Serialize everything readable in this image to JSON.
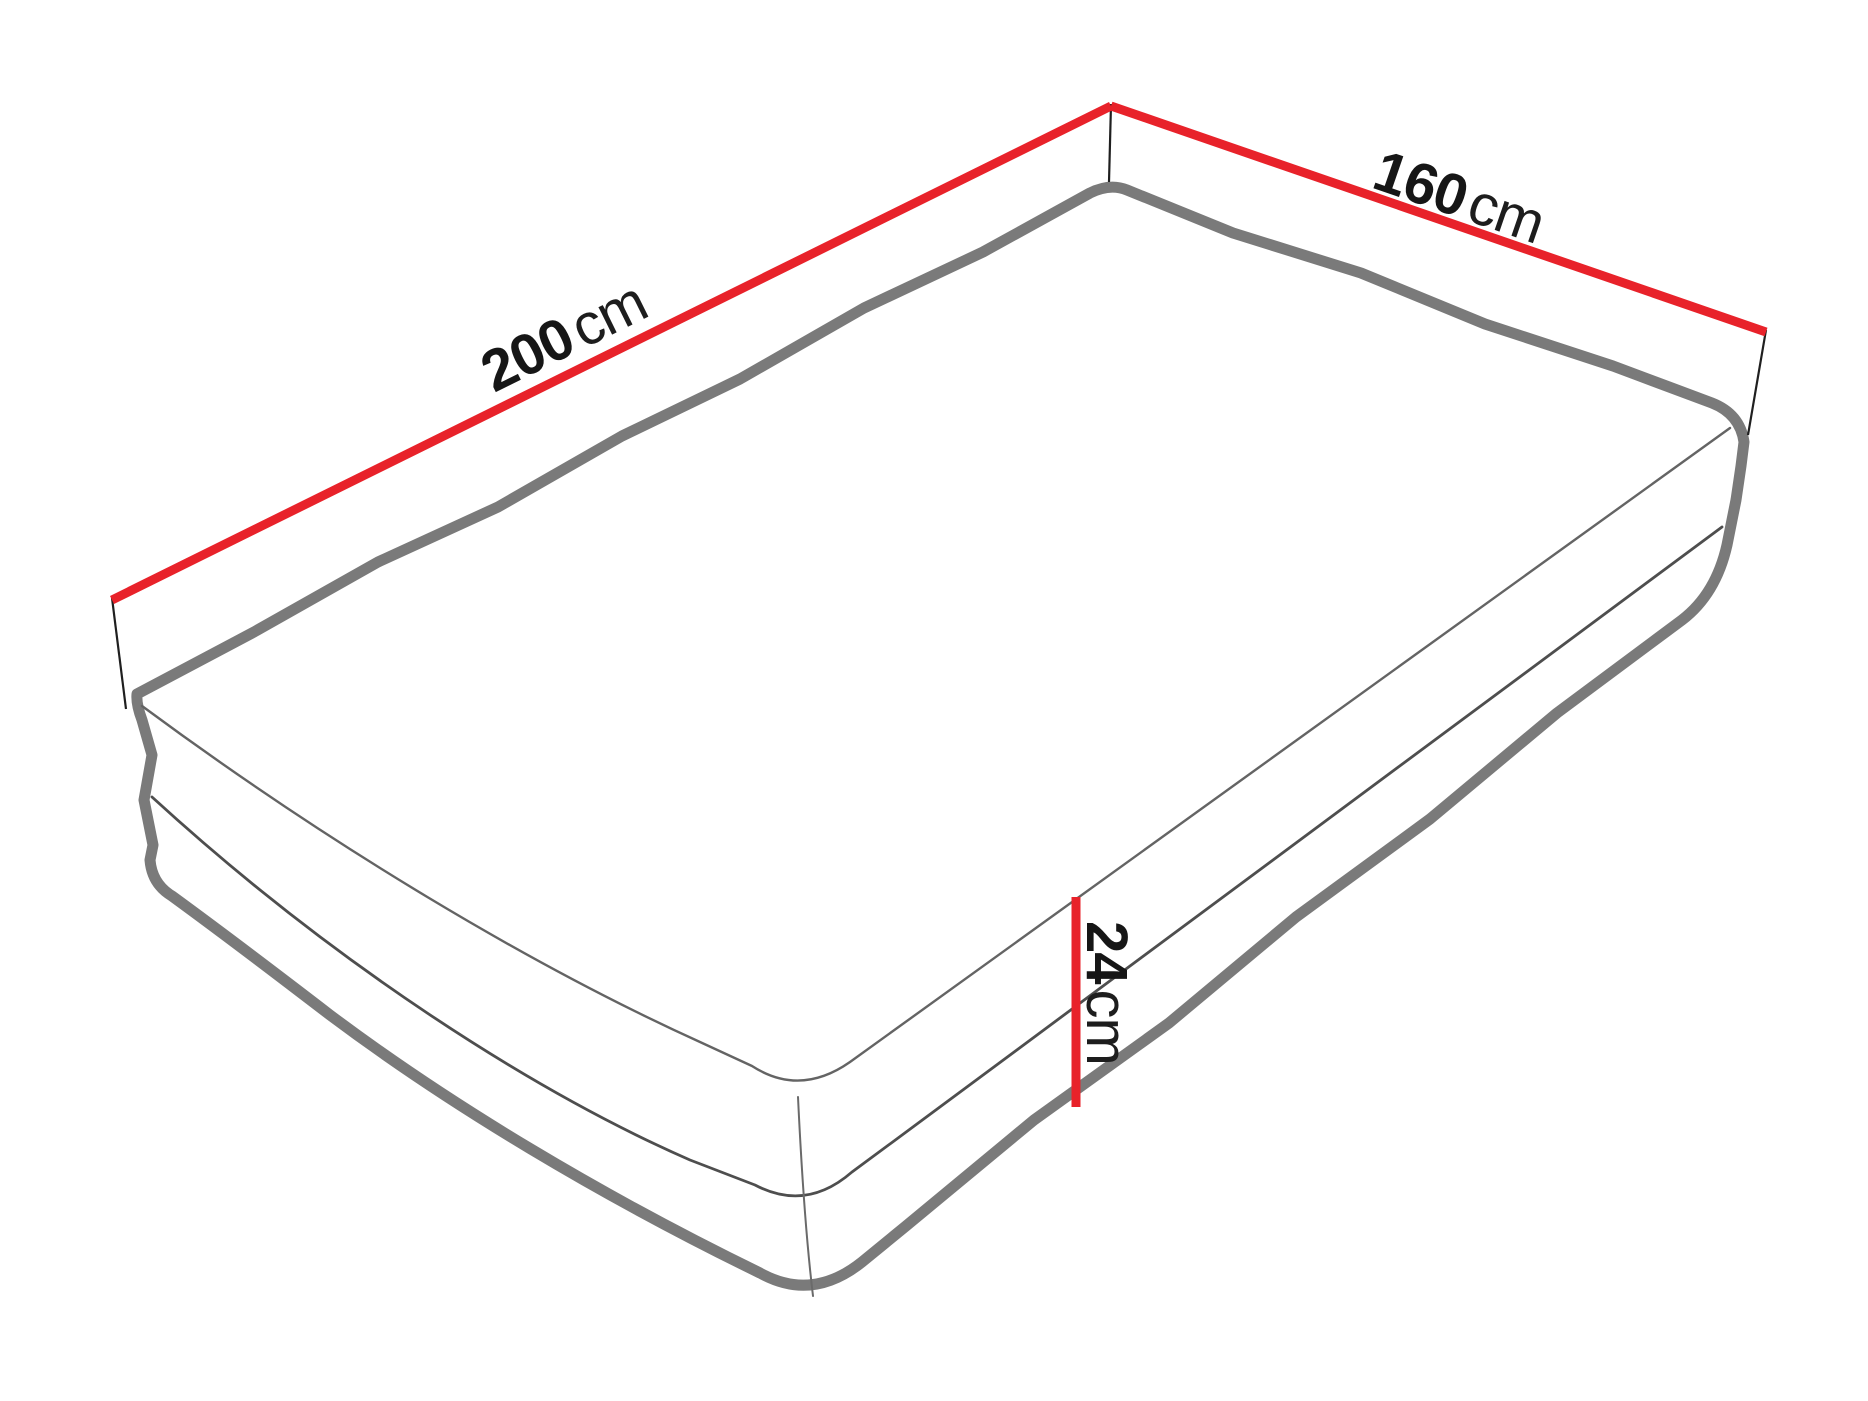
{
  "figure": {
    "title": "Mattress dimensions diagram",
    "object": "mattress",
    "background_color": "#ffffff",
    "colors": {
      "dimension_line": "#e8222a",
      "mattress_outline": "#7a7a7a",
      "seam_line": "#4e4e4e",
      "extension_line": "#1f1f1f",
      "label_text": "#161616"
    },
    "dimensions": {
      "length": {
        "value": "200",
        "unit": "cm"
      },
      "width": {
        "value": "160",
        "unit": "cm"
      },
      "height": {
        "value": "24",
        "unit": "cm"
      }
    }
  }
}
